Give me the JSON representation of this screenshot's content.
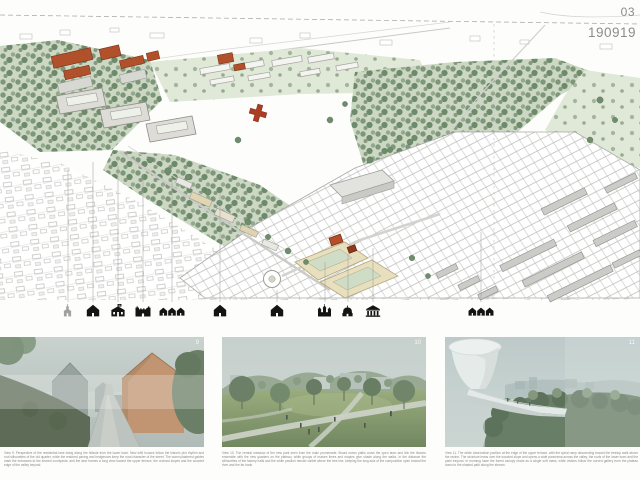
{
  "header": {
    "sheet_number": "03",
    "date_code": "190919"
  },
  "map": {
    "landmark_icons": [
      "church",
      "house",
      "school",
      "fortress",
      "house-group",
      "house",
      "house",
      "castle",
      "rotunda",
      "museum",
      "house-group"
    ],
    "colors": {
      "tree_green": "#7e977a",
      "accent_roof": "#b0512c",
      "context_line": "#c0c0be",
      "ink": "#8c8c8c"
    }
  },
  "figures": [
    {
      "corner_label": "9",
      "caption": "View 9. Perspective of the residential lane rising along the hillside from the lower town. New infill houses follow the historic plot rhythm and roof silhouettes of the old quarter, while the restored paving and hedgerows keep the rural character of the street. The warm plastered gables mark the entrances to the shared courtyards, and the lane frames a long view toward the upper terrace, the orchard slopes and the wooded edge of the valley beyond."
    },
    {
      "corner_label": "10",
      "caption": "View 10. The central meadow of the new park seen from the main promenade. Broad mown paths cross the open lawn and link the historic ensemble with the new quarters on the plateau, while groups of mature limes and maples give shade along the walks. In the distance the silhouettes of the factory halls and the white pavilion remain visible above the tree line, keeping the long axis of the composition open toward the river and the far bank."
    },
    {
      "corner_label": "11",
      "caption": "View 11. The white observation pavilion at the edge of the upper terrace, with the spiral ramp descending toward the treetop walk above the ravine. The structure leans over the wooded slope and opens a wide panorama across the valley, the roofs of the lower town and the plain beyond. In morning haze the forest canopy reads as a single soft mass, while visitors follow the curved gallery from the plateau down to the shaded path along the stream."
    }
  ]
}
